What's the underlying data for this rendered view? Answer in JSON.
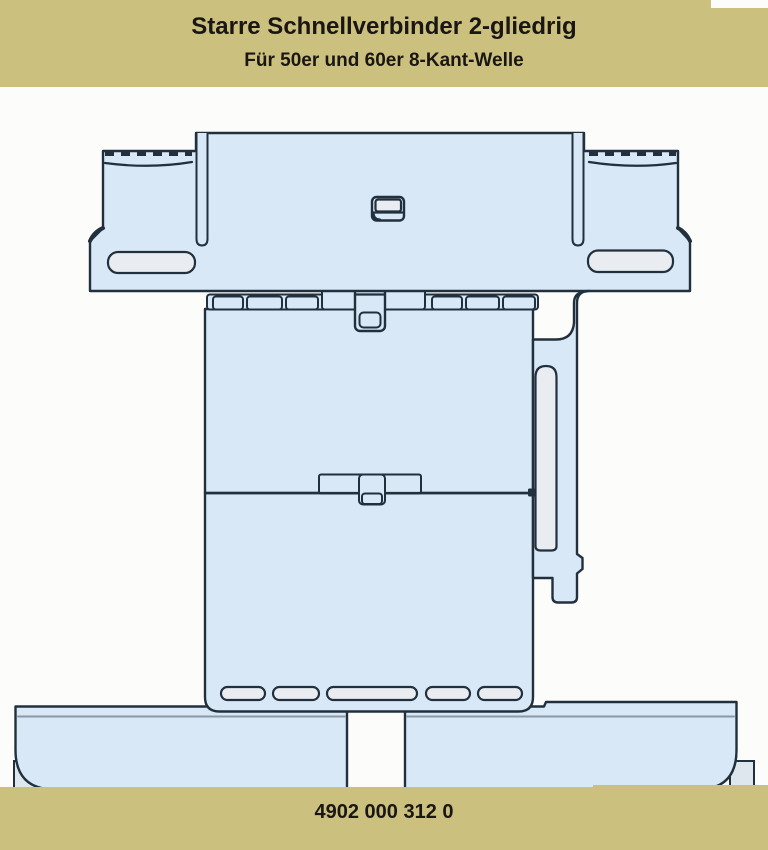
{
  "header": {
    "title": "Starre Schnellverbinder 2-gliedrig",
    "subtitle": "Für 50er und 60er 8-Kant-Welle"
  },
  "footer": {
    "product_number": "4902 000 312 0"
  },
  "colors": {
    "khaki": "#CBC07D",
    "header_text": "#1A1613",
    "page_background": "#FCFCFB",
    "diagram_fill": "#D8E8F6",
    "diagram_slot_fill": "#E9EDF2",
    "diagram_outline": "#22303E",
    "shading": "#8D99A6"
  }
}
